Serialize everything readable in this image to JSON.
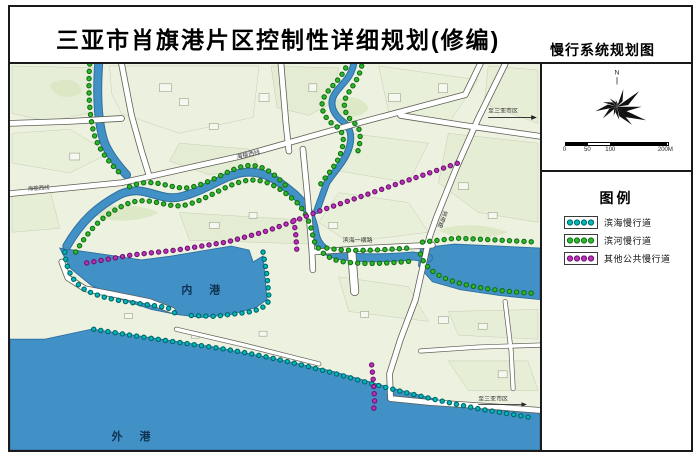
{
  "page": {
    "title": "三亚市肖旗港片区控制性详细规划(修编)",
    "subtitle": "慢行系统规划图"
  },
  "map": {
    "labels": {
      "inner_port": "内 港",
      "outer_port": "外 港",
      "road_haiyu": "海榆西线",
      "road_haiyu_west": "海榆西线",
      "road_binhai": "滨海路",
      "road_binhai_yiheng": "滨海一横路",
      "to_sanya_top": "至三亚市区",
      "to_sanya_bottom": "至三亚市区"
    },
    "colors": {
      "land": "#edf2e0",
      "water": "#4190c6",
      "road_fill": "#ffffff",
      "road_casing": "#5f5f55"
    }
  },
  "compass": {
    "north_label": "N"
  },
  "scale_bar": {
    "ticks": [
      "0",
      "50",
      "100",
      "200M"
    ]
  },
  "legend": {
    "title": "图例",
    "items": [
      {
        "label": "滨海慢行道",
        "color": "#00b9b9",
        "outline": "#00666a"
      },
      {
        "label": "滨河慢行道",
        "color": "#2eb82e",
        "outline": "#146e14"
      },
      {
        "label": "其他公共慢行道",
        "color": "#bb2fbb",
        "outline": "#6e156e"
      }
    ]
  }
}
